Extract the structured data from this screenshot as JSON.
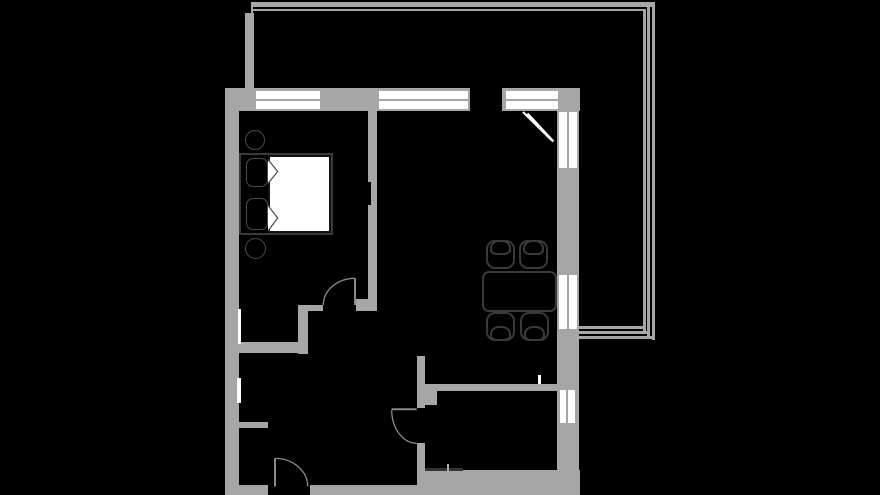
{
  "colors": {
    "background": "#000000",
    "wall": "#a6a6a6",
    "window": "#ffffff",
    "furniture_outline": "#3a3a3a",
    "soft_outline": "#4a4a4a",
    "door_swing": "#8a8a8a",
    "dark_line": "#333333",
    "tick_gray": "#aaaaaa"
  },
  "plan": {
    "type": "apartment-floor-plan",
    "windows_top_wall": 3,
    "windows_right_wall": 3,
    "doors": 3,
    "balcony": true,
    "furniture": {
      "double_bed": 1,
      "pillows": 2,
      "round_stools": 2,
      "dining_table": 1,
      "dining_chairs": 4
    }
  }
}
